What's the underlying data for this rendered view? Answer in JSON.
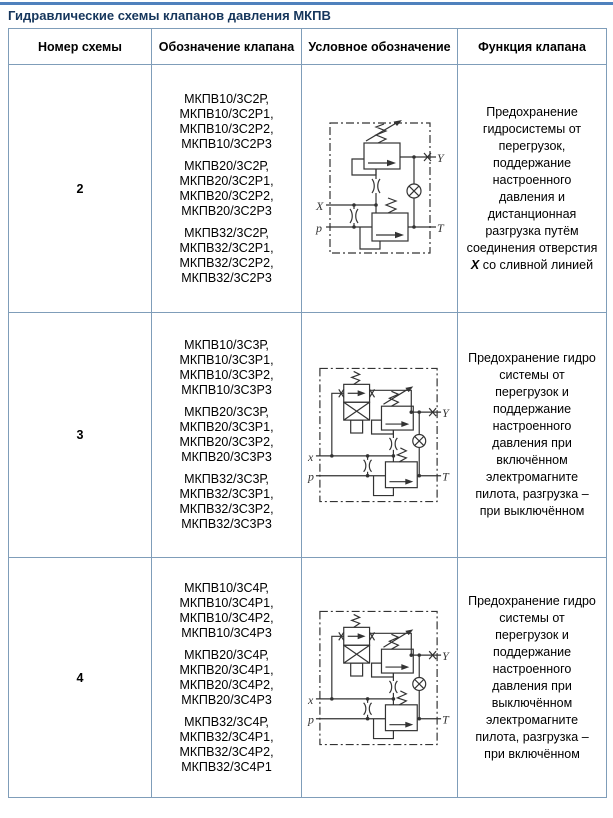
{
  "page_title": "Гидравлические схемы клапанов давления МКПВ",
  "colors": {
    "top_rule": "#4f81bd",
    "table_border": "#7f9db9",
    "title_text": "#16365c",
    "body_text": "#000000",
    "diagram_stroke": "#333333",
    "background": "#ffffff"
  },
  "table": {
    "headers": [
      "Номер схемы",
      "Обозначение клапана",
      "Условное обозначение",
      "Функция клапана"
    ],
    "rows": [
      {
        "number": "2",
        "row_height": 248,
        "designation_groups": [
          [
            "МКПВ10/3С2Р,",
            "МКПВ10/3С2Р1,",
            "МКПВ10/3С2Р2,",
            "МКПВ10/3С2Р3"
          ],
          [
            "МКПВ20/3С2Р,",
            "МКПВ20/3С2Р1,",
            "МКПВ20/3С2Р2,",
            "МКПВ20/3С2Р3"
          ],
          [
            "МКПВ32/3С2Р,",
            "МКПВ32/3С2Р1,",
            "МКПВ32/3С2Р2,",
            "МКПВ32/3С2Р3"
          ]
        ],
        "diagram": {
          "variant": "scheme2",
          "description": "relief valve with pilot stage, remote unloading via port X",
          "ports": {
            "x": "X",
            "p": "p",
            "y": "Y",
            "t": "T"
          }
        },
        "function_segments": [
          {
            "text": "Предохранение гидросистемы от перегрузок, поддержание настроенного давления и дистанционная разгрузка путём соединения отверстия ",
            "emphasis": false
          },
          {
            "text": "X",
            "emphasis": true
          },
          {
            "text": " со сливной линией",
            "emphasis": false
          }
        ]
      },
      {
        "number": "3",
        "row_height": 245,
        "designation_groups": [
          [
            "МКПВ10/3С3Р,",
            "МКПВ10/3С3Р1,",
            "МКПВ10/3С3Р2,",
            "МКПВ10/3С3Р3"
          ],
          [
            "МКПВ20/3С3Р,",
            "МКПВ20/3С3Р1,",
            "МКПВ20/3С3Р2,",
            "МКПВ20/3С3Р3"
          ],
          [
            "МКПВ32/3С3Р,",
            "МКПВ32/3С3Р1,",
            "МКПВ32/3С3Р2,",
            "МКПВ32/3С3Р3"
          ]
        ],
        "diagram": {
          "variant": "scheme3",
          "description": "relief valve with pilot stage and solenoid pilot valve",
          "ports": {
            "x": "x",
            "p": "p",
            "y": "Y",
            "t": "T"
          }
        },
        "function_segments": [
          {
            "text": "Предохранение гидро системы от перегрузок и поддержание настроенного давления при включённом электромагните пилота, разгрузка – при выключённом",
            "emphasis": false
          }
        ]
      },
      {
        "number": "4",
        "row_height": 240,
        "designation_groups": [
          [
            "МКПВ10/3С4Р,",
            "МКПВ10/3С4Р1,",
            "МКПВ10/3С4Р2,",
            "МКПВ10/3С4Р3"
          ],
          [
            "МКПВ20/3С4Р,",
            "МКПВ20/3С4Р1,",
            "МКПВ20/3С4Р2,",
            "МКПВ20/3С4Р3"
          ],
          [
            "МКПВ32/3С4Р,",
            "МКПВ32/3С4Р1,",
            "МКПВ32/3С4Р2,",
            "МКПВ32/3С4Р1"
          ]
        ],
        "diagram": {
          "variant": "scheme4",
          "description": "relief valve with pilot stage and solenoid pilot valve (inverse logic)",
          "ports": {
            "x": "x",
            "p": "p",
            "y": "Y",
            "t": "T"
          }
        },
        "function_segments": [
          {
            "text": "Предохранение гидро системы от перегрузок и поддержание настроенного давления при выключённом электромагните пилота, разгрузка – при включённом",
            "emphasis": false
          }
        ]
      }
    ]
  }
}
